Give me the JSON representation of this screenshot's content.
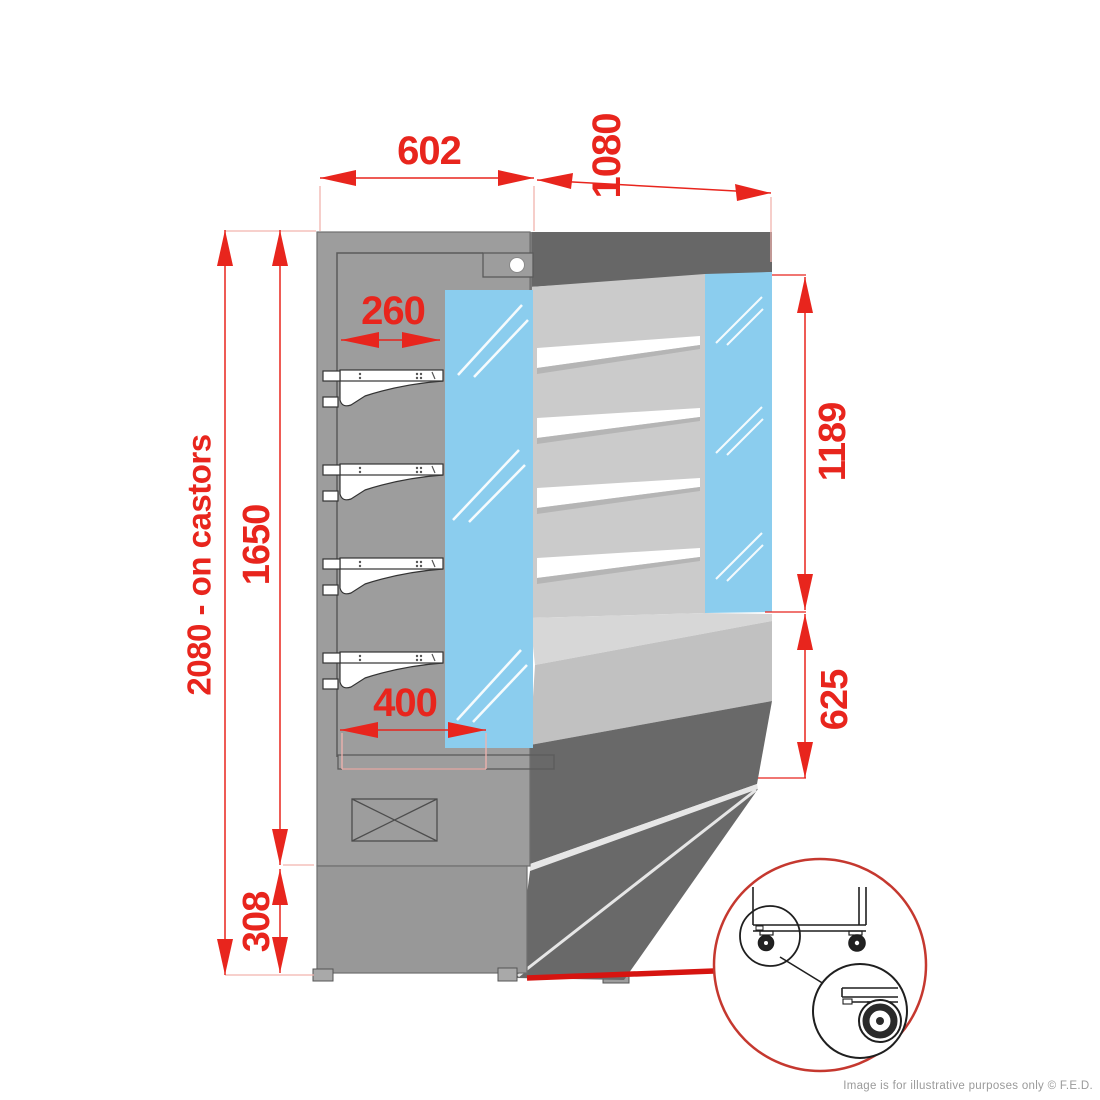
{
  "diagram": {
    "dimensions": {
      "top_width": "602",
      "top_depth": "1080",
      "shelf_depth": "260",
      "glass_opening_height": "1189",
      "base_front_height": "625",
      "base_depth": "400",
      "body_height": "1650",
      "overall_height": "2080 - on castors",
      "plinth_height": "308"
    },
    "footer_note": "Image is for illustrative purposes only  © F.E.D.",
    "colors": {
      "dimension_red": "#e8251d",
      "extension_pink": "#f2b3ae",
      "glass_blue": "#8bcdee",
      "cabinet_gray": "#9d9d9d",
      "interior_gray": "#cbcbcb",
      "dark_gray": "#696969",
      "detail_circle_red": "#c5382f",
      "pointer_red": "#d61410"
    }
  }
}
